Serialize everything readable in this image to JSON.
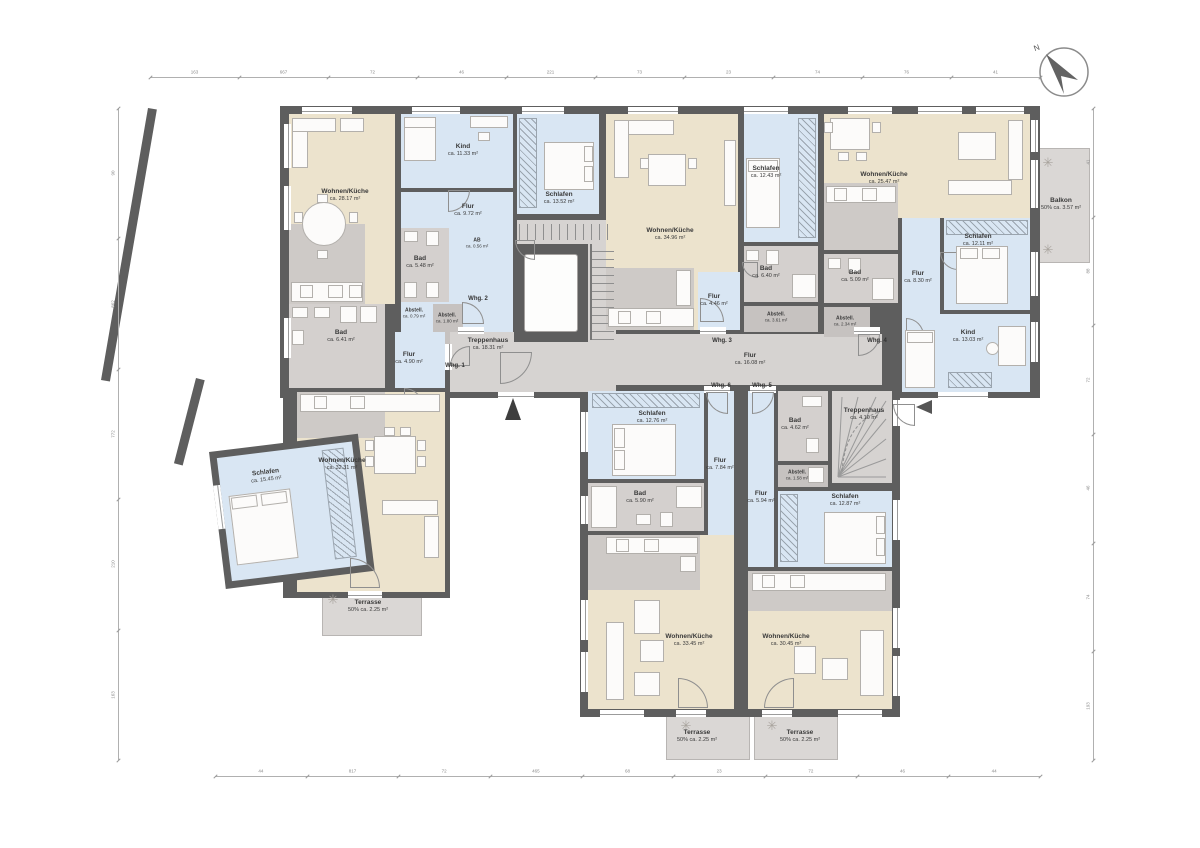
{
  "compass": {
    "label": "N"
  },
  "icons": {
    "tree": "✳"
  },
  "rooms": {
    "whg2_wohnkueche": {
      "name": "Wohnen/Küche",
      "area": "ca. 28.17 m²"
    },
    "whg2_kind": {
      "name": "Kind",
      "area": "ca. 11.33 m²"
    },
    "whg2_flur": {
      "name": "Flur",
      "area": "ca. 9.72 m²"
    },
    "whg2_schlafen": {
      "name": "Schlafen",
      "area": "ca. 13.52 m²"
    },
    "whg2_bad": {
      "name": "Bad",
      "area": "ca. 5.48 m²"
    },
    "whg2_ab": {
      "name": "AB",
      "area": "ca. 0.56 m²"
    },
    "whg2_abstell": {
      "name": "Abstell.",
      "area": "ca. 1.80 m²"
    },
    "whg1_abstell": {
      "name": "Abstell.",
      "area": "ca. 0.79 m²"
    },
    "whg1_bad": {
      "name": "Bad",
      "area": "ca. 6.41 m²"
    },
    "whg1_flur": {
      "name": "Flur",
      "area": "ca. 4.90 m²"
    },
    "whg1_wohnkueche": {
      "name": "Wohnen/Küche",
      "area": "ca. 32.31 m²"
    },
    "whg1_schlafen": {
      "name": "Schlafen",
      "area": "ca. 15.45 m²"
    },
    "whg1_terrasse": {
      "name": "Terrasse",
      "area": "50% ca. 2.25 m²"
    },
    "treppenhaus": {
      "name": "Treppenhaus",
      "area": "ca. 18.31 m²"
    },
    "corridor": {
      "name": "Flur",
      "area": "ca. 16.08 m²"
    },
    "whg3_wohnkueche": {
      "name": "Wohnen/Küche",
      "area": "ca. 34.96 m²"
    },
    "whg3_schlafen": {
      "name": "Schlafen",
      "area": "ca. 12.43 m²"
    },
    "whg3_bad": {
      "name": "Bad",
      "area": "ca. 6.40 m²"
    },
    "whg3_flur": {
      "name": "Flur",
      "area": "ca. 4.46 m²"
    },
    "whg3_abstell": {
      "name": "Abstell.",
      "area": "ca. 3.61 m²"
    },
    "whg4_wohnkueche": {
      "name": "Wohnen/Küche",
      "area": "ca. 25.47 m²"
    },
    "whg4_bad": {
      "name": "Bad",
      "area": "ca. 5.09 m²"
    },
    "whg4_abstell": {
      "name": "Abstell.",
      "area": "ca. 2.34 m²"
    },
    "whg4_flur": {
      "name": "Flur",
      "area": "ca. 8.30 m²"
    },
    "whg4_schlafen": {
      "name": "Schlafen",
      "area": "ca. 12.11 m²"
    },
    "whg4_kind": {
      "name": "Kind",
      "area": "ca. 13.03 m²"
    },
    "whg4_balkon": {
      "name": "Balkon",
      "area": "50% ca. 3.57 m²"
    },
    "whg6_schlafen": {
      "name": "Schlafen",
      "area": "ca. 12.76 m²"
    },
    "whg6_flur": {
      "name": "Flur",
      "area": "ca. 7.84 m²"
    },
    "whg6_bad": {
      "name": "Bad",
      "area": "ca. 5.90 m²"
    },
    "whg6_wohnkueche": {
      "name": "Wohnen/Küche",
      "area": "ca. 33.45 m²"
    },
    "whg6_terrasse": {
      "name": "Terrasse",
      "area": "50% ca. 2.25 m²"
    },
    "whg5_bad": {
      "name": "Bad",
      "area": "ca. 4.62 m²"
    },
    "whg5_abstell": {
      "name": "Abstell.",
      "area": "ca. 1.58 m²"
    },
    "whg5_flur": {
      "name": "Flur",
      "area": "ca. 5.94 m²"
    },
    "whg5_schlafen": {
      "name": "Schlafen",
      "area": "ca. 12.87 m²"
    },
    "whg5_wohnkueche": {
      "name": "Wohnen/Küche",
      "area": "ca. 30.45 m²"
    },
    "whg5_terrasse": {
      "name": "Terrasse",
      "area": "50% ca. 2.25 m²"
    },
    "treppenhaus2": {
      "name": "Treppenhaus",
      "area": "ca. 4.10 m²"
    }
  },
  "units": {
    "whg1": "Whg. 1",
    "whg2": "Whg. 2",
    "whg3": "Whg. 3",
    "whg4": "Whg. 4",
    "whg5": "Whg. 5",
    "whg6": "Whg. 6"
  },
  "dimensions": {
    "top": [
      "163",
      "667",
      "72",
      "46",
      "221",
      "73",
      "23",
      "74",
      "76",
      "41"
    ],
    "bottom": [
      "44",
      "817",
      "72",
      "465",
      "68",
      "23",
      "72",
      "46",
      "44"
    ],
    "left": [
      "90",
      "862",
      "772",
      "210",
      "163"
    ],
    "right": [
      "41",
      "88",
      "72",
      "46",
      "74",
      "193"
    ]
  }
}
